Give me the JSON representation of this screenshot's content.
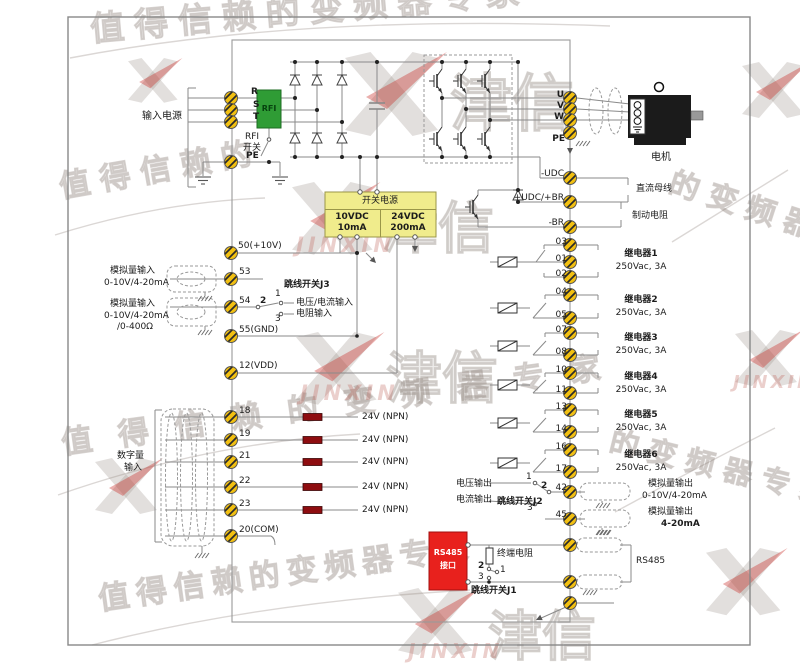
{
  "watermark": {
    "slogan": "值得信赖的变频器专家",
    "partial_a": "值得信赖的",
    "partial_b": "的变频器",
    "partial_c": "的变频器专家",
    "brand_cn": "津信",
    "brand_en": "JINXIN"
  },
  "power_input": {
    "group": "输入电源",
    "terminals": [
      "R",
      "S",
      "T",
      "PE"
    ],
    "rfi": "RFI",
    "rfi_switch": [
      "RFI",
      "开关"
    ]
  },
  "smps": {
    "title": "开关电源",
    "col1": [
      "10VDC",
      "10mA"
    ],
    "col2": [
      "24VDC",
      "200mA"
    ]
  },
  "analog_in": {
    "t50": "50(+10V)",
    "t53": "53",
    "t54": "54",
    "t55": "55(GND)",
    "t12": "12(VDD)",
    "ai1": [
      "模拟量输入",
      "0-10V/4-20mA"
    ],
    "ai2": [
      "模拟量输入",
      "0-10V/4-20mA",
      "/0-400Ω"
    ],
    "j3": {
      "title": "跳线开关J3",
      "p1": "1",
      "p2": "2",
      "p3": "3",
      "opt1": "电压/电流输入",
      "opt3": "电阻输入"
    }
  },
  "digital_in": {
    "group": [
      "数字量",
      "输入"
    ],
    "rows": [
      {
        "t": "18",
        "label": "24V (NPN)"
      },
      {
        "t": "19",
        "label": "24V (NPN)"
      },
      {
        "t": "21",
        "label": "24V (NPN)"
      },
      {
        "t": "22",
        "label": "24V (NPN)"
      },
      {
        "t": "23",
        "label": "24V (NPN)"
      }
    ],
    "com": "20(COM)"
  },
  "output": {
    "terminals": [
      "U",
      "V",
      "W",
      "PE"
    ],
    "motor": "电机"
  },
  "dc": {
    "neg": "-UDC",
    "pos": "+UDC/+BR",
    "br": "-BR",
    "bus": "直流母线",
    "brake": "制动电阻"
  },
  "relays": {
    "items": [
      {
        "name": "继电器1",
        "rating": "250Vac, 3A",
        "t": [
          "03",
          "01",
          "02"
        ]
      },
      {
        "name": "继电器2",
        "rating": "250Vac, 3A",
        "t": [
          "04",
          "05"
        ]
      },
      {
        "name": "继电器3",
        "rating": "250Vac, 3A",
        "t": [
          "07",
          "08"
        ]
      },
      {
        "name": "继电器4",
        "rating": "250Vac, 3A",
        "t": [
          "10",
          "11"
        ]
      },
      {
        "name": "继电器5",
        "rating": "250Vac, 3A",
        "t": [
          "13",
          "14"
        ]
      },
      {
        "name": "继电器6",
        "rating": "250Vac, 3A",
        "t": [
          "16",
          "17"
        ]
      }
    ]
  },
  "analog_out": {
    "t42": "42",
    "t45": "45",
    "j2": {
      "title": "跳线开关J2",
      "p1": "1",
      "p2": "2",
      "p3": "3",
      "volt": "电压输出",
      "curr": "电流输出"
    },
    "ao1": [
      "模拟量输出",
      "0-10V/4-20mA"
    ],
    "ao2": [
      "模拟量输出",
      "4-20mA"
    ]
  },
  "rs485": {
    "box": [
      "RS485",
      "接口"
    ],
    "resistor": "终端电阻",
    "j1": {
      "title": "跳线开关J1",
      "p1": "1",
      "p2": "2",
      "p3": "3"
    },
    "label": "RS485"
  },
  "colors": {
    "terminal_gold": "#F2C011",
    "rfi_green": "#2F9C35",
    "smps_yellow": "#F0EC8C",
    "rs485_red": "#E8211D",
    "npn_resistor": "#8E0D10",
    "motor_black": "#1B1B1B",
    "wire_gray": "#8A8A8A"
  }
}
